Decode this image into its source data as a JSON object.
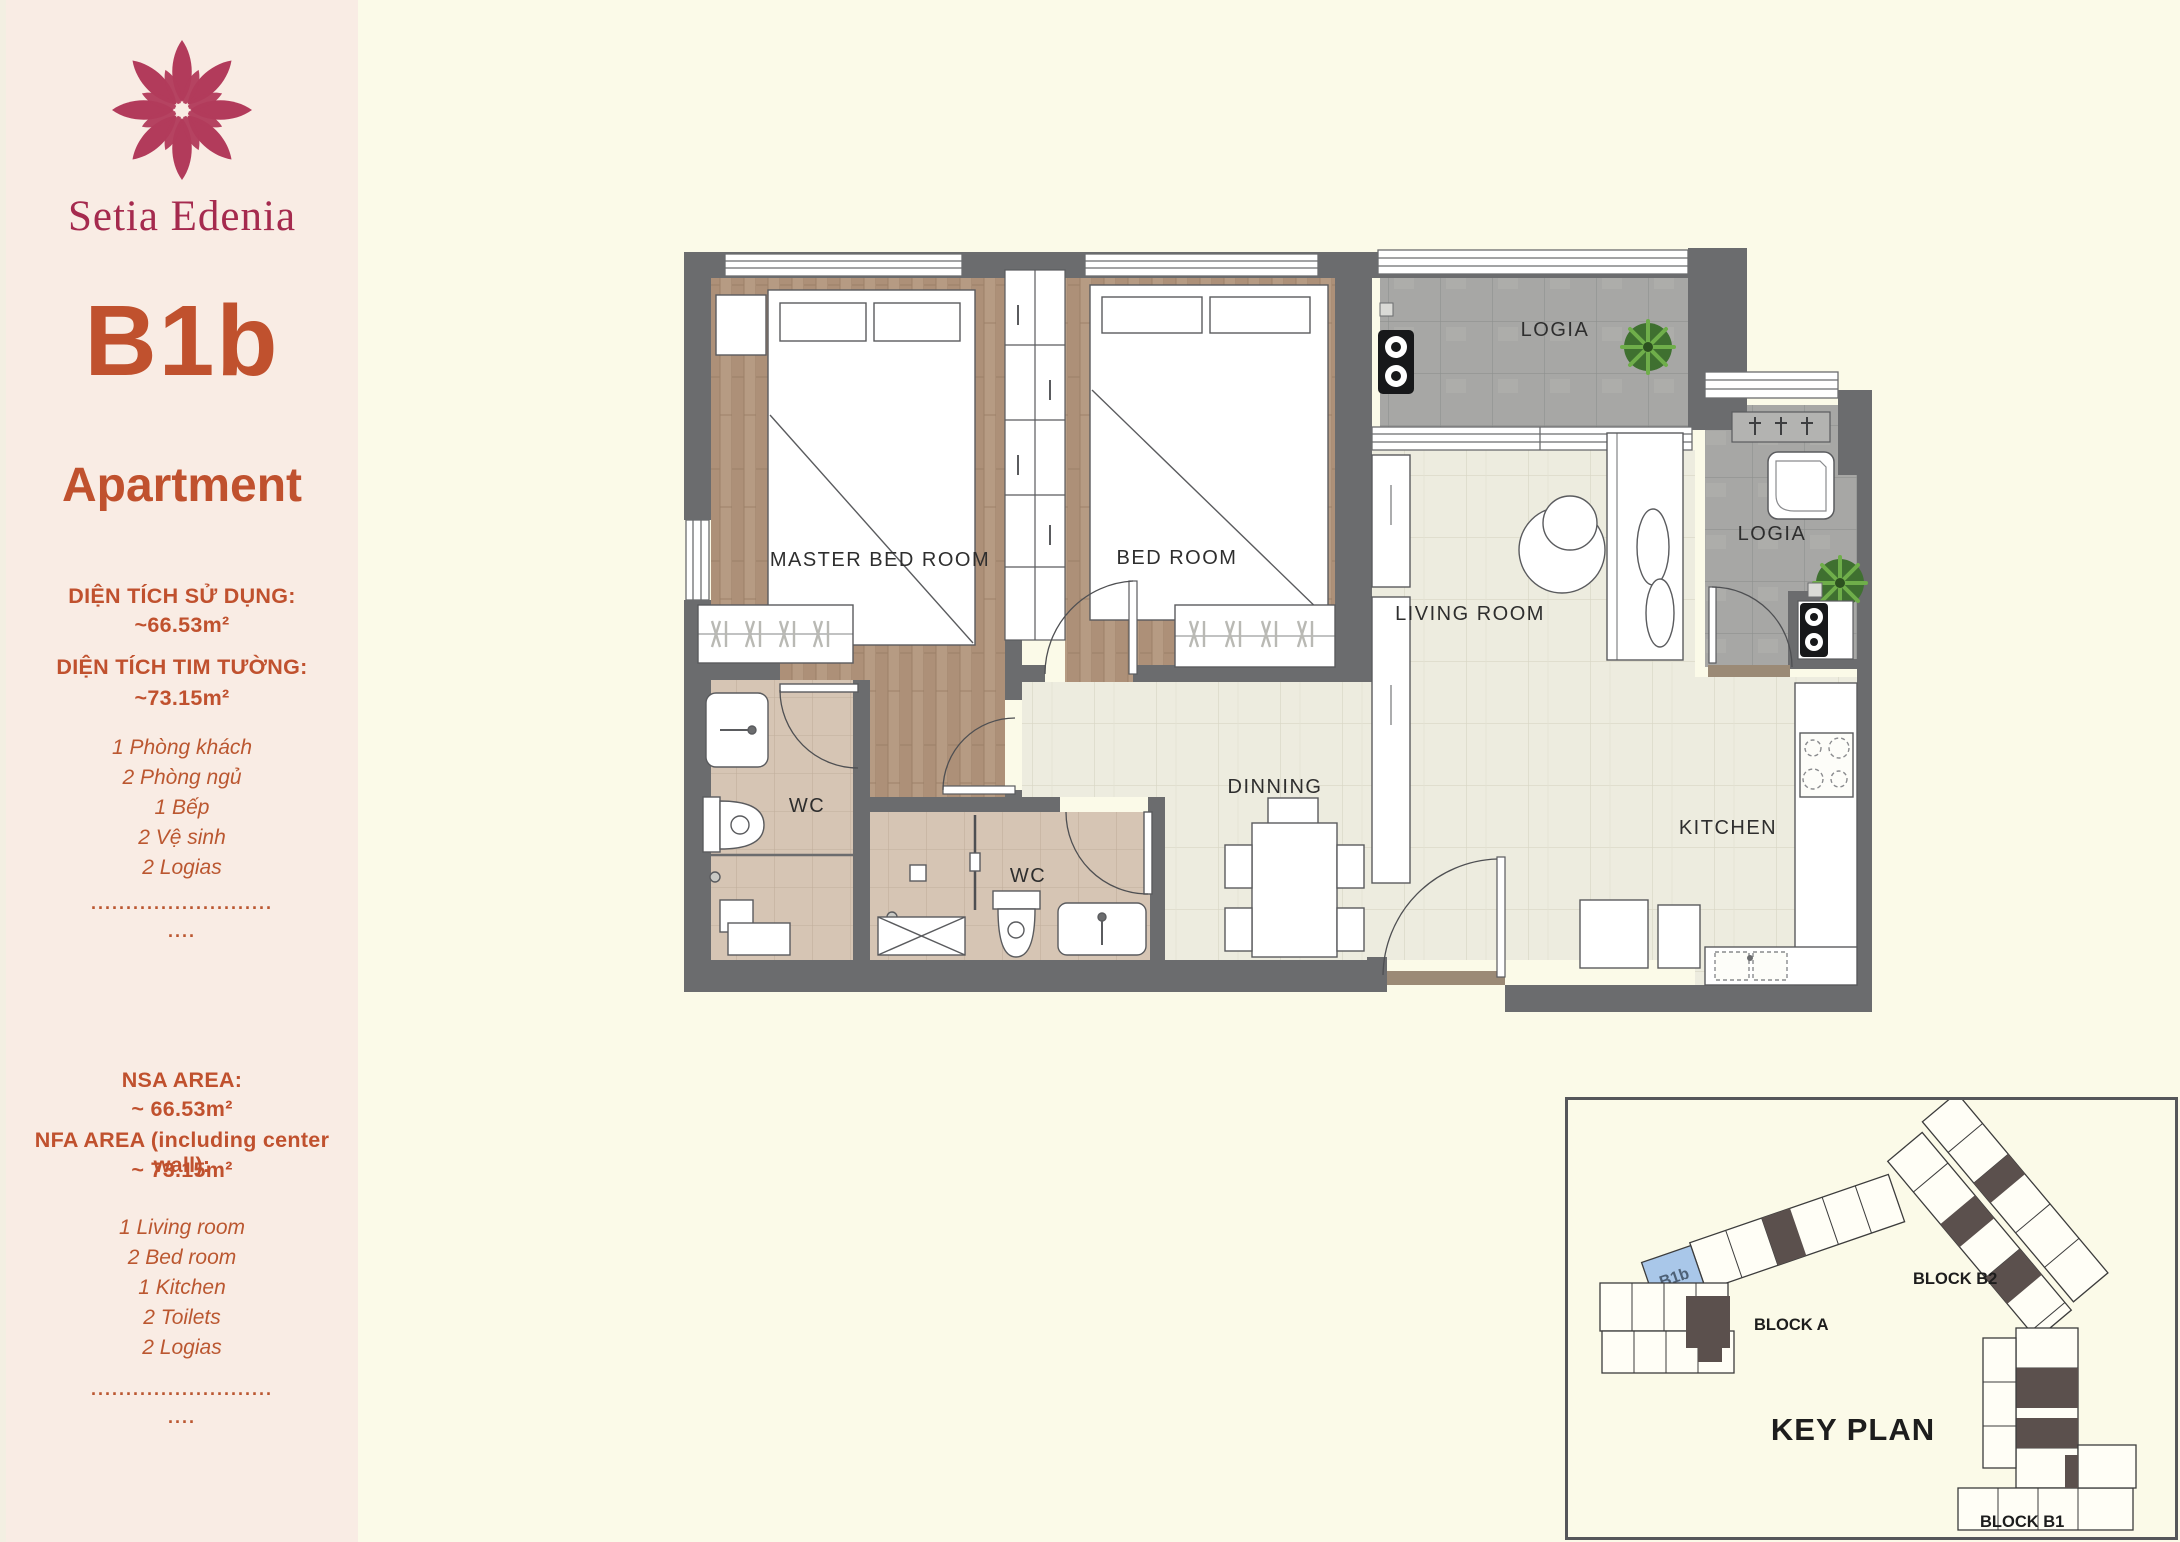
{
  "sidebar": {
    "brand": "Setia Edenia",
    "unit_code": "B1b",
    "unit_type": "Apartment",
    "vn": {
      "usable_area_label": "DIỆN TÍCH SỬ DỤNG:",
      "usable_area_value": "~66.53m²",
      "wall_area_label": "DIỆN TÍCH TIM TƯỜNG:",
      "wall_area_value": "~73.15m²",
      "items": [
        "1 Phòng khách",
        "2 Phòng ngủ",
        "1 Bếp",
        "2 Vệ sinh",
        "2 Logias"
      ]
    },
    "en": {
      "nsa_label": "NSA AREA:",
      "nsa_value": "~ 66.53m²",
      "nfa_label": "NFA AREA (including center wall):",
      "nfa_value": "~ 73.15m²",
      "items": [
        "1 Living room",
        "2 Bed room",
        "1 Kitchen",
        "2 Toilets",
        "2 Logias"
      ]
    },
    "dots_long": "..........................",
    "dots_short": "...."
  },
  "floor_plan": {
    "rooms": {
      "master_bedroom": "MASTER BED ROOM",
      "bedroom": "BED ROOM",
      "living_room": "LIVING ROOM",
      "dining": "DINNING",
      "kitchen": "KITCHEN",
      "wc1": "WC",
      "wc2": "WC",
      "logia1": "LOGIA",
      "logia2": "LOGIA"
    }
  },
  "key_plan": {
    "title": "KEY PLAN",
    "highlighted_unit": "B1b",
    "blocks": {
      "a": "BLOCK A",
      "b2": "BLOCK B2",
      "b1": "BLOCK B1"
    }
  },
  "colors": {
    "accent_orange": "#c0512e",
    "brand_maroon": "#a52a4e",
    "wall_gray": "#6b6c6e",
    "unit_highlight_blue": "#a9c7e9",
    "wood_floor": "#b69b83",
    "living_tile": "#edecdf",
    "wc_tile": "#d6c5b4",
    "logia_tile": "#a7a7a5"
  }
}
